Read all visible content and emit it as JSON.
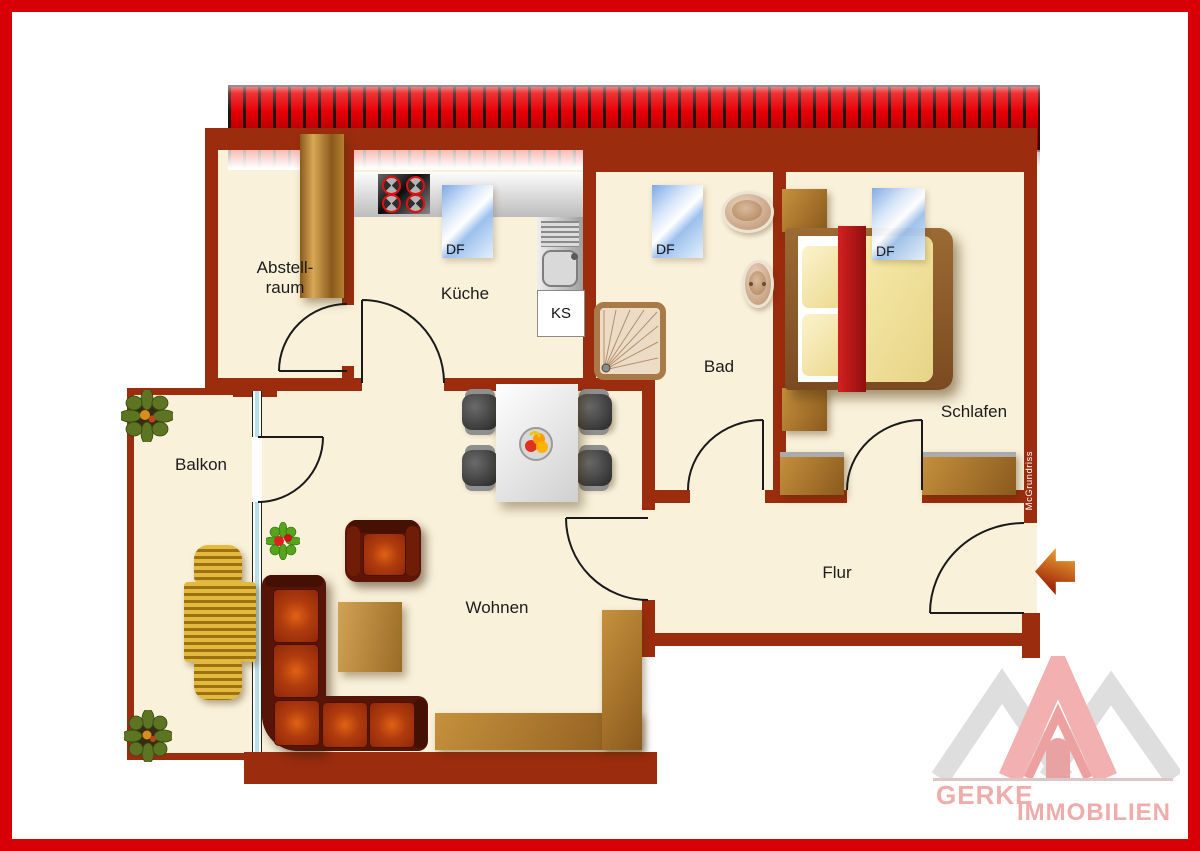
{
  "rooms": {
    "abstellraum": {
      "line1": "Abstell-",
      "line2": "raum"
    },
    "kueche": {
      "label": "Küche"
    },
    "bad": {
      "label": "Bad"
    },
    "schlafen": {
      "label": "Schlafen"
    },
    "balkon": {
      "label": "Balkon"
    },
    "wohnen": {
      "label": "Wohnen"
    },
    "flur": {
      "label": "Flur"
    }
  },
  "windows": {
    "kueche": "DF",
    "bad": "DF",
    "schlafen": "DF"
  },
  "fridge_label": "KS",
  "watermark": "McGrundriss",
  "brand": {
    "line1": "GERKE",
    "line2": "IMMOBILIEN"
  },
  "icons": [
    "entrance-arrow-icon",
    "roof-edge",
    "logo-roof-peaks"
  ],
  "colors": {
    "frame_red": "#d80006",
    "wall_brick": "#9c2c0e",
    "floor_cream": "#f9f1da",
    "roof_stripe_red": "#e60005",
    "wood_brown": "#b07b2a",
    "sofa_orange": "#d95b10",
    "window_blue": "#9cc0ee",
    "logo_pink": "#f0abab",
    "logo_gray": "#dedede"
  }
}
